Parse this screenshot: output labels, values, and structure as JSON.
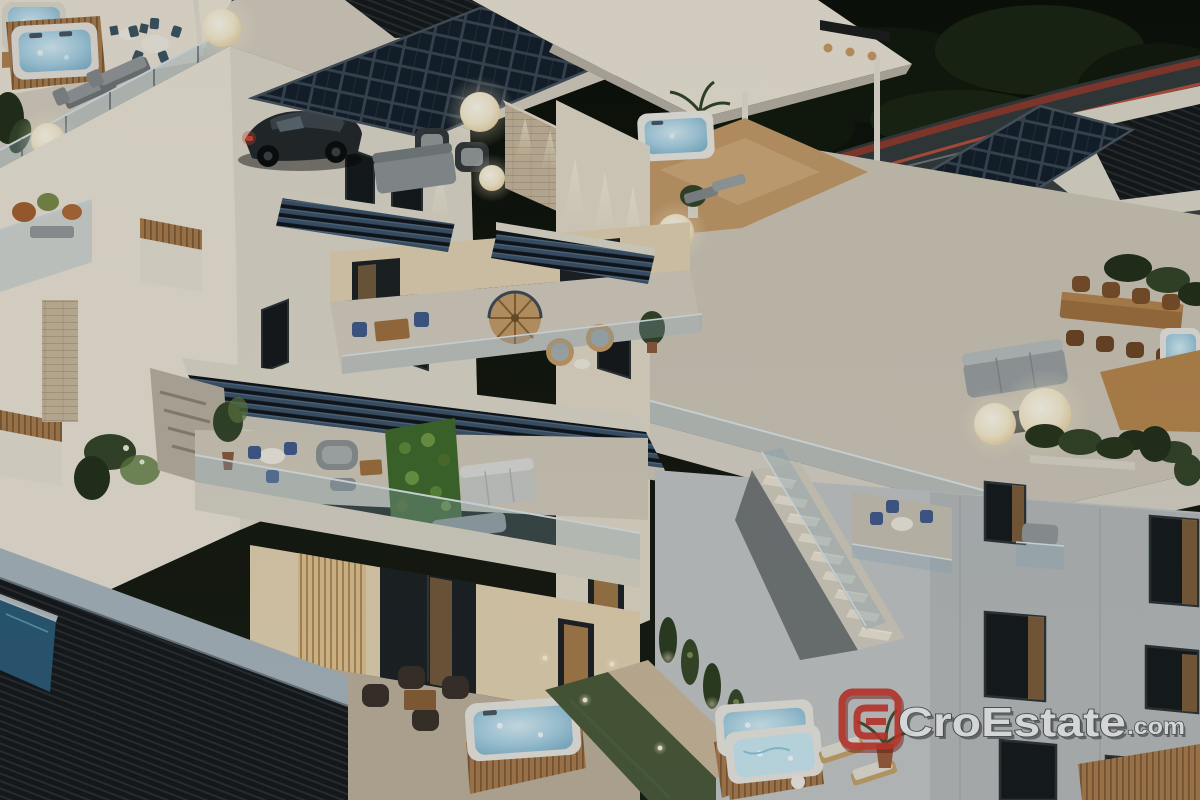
{
  "image": {
    "kind": "3d-architectural-rendering",
    "scene": "modern terraced apartment complex at dusk",
    "time_of_day": "dusk"
  },
  "watermark": {
    "brand": "CroEstate",
    "suffix": ".com",
    "emblem": "ce-monogram",
    "emblem_color": "#b23128",
    "text_fill": "#d9dbdd",
    "text_outline": "#3f4448"
  },
  "palette": {
    "c-night": "#0e120c",
    "c-veg": "#1b2615",
    "c-veg-dark": "#11190d",
    "c-road": "#333a3d",
    "c-apron": "#42484c",
    "c-trail-red": "#b23a28",
    "c-trail-red2": "#d8553c",
    "c-trail-light": "#dceef5",
    "c-pool": "#2a6484",
    "c-pool-lane": "#85c8de",
    "c-wall-lit": "#ece5d8",
    "c-wall-mid": "#d6cfc2",
    "c-wall-shade": "#b9b1a3",
    "c-wall-warm": "#e4d3b4",
    "c-brick": "#c9b89d",
    "c-brick-dark": "#a4937a",
    "c-facade-cool": "#c3c6c8",
    "c-facade-cool-dark": "#9da3a7",
    "c-window-dark": "#14191d",
    "c-frame": "#2c3338",
    "c-glass": "#8fb0c4",
    "c-slat-blue": "#3c536b",
    "c-slat-gap": "#101722",
    "c-deck-dark": "#16191c",
    "c-wood": "#b08353",
    "c-wood-dark": "#82603c",
    "c-wood-deck": "#c49a6a",
    "c-water": "#a3cfe3",
    "c-water-bright": "#c9e8f4",
    "c-lamp": "#f7ecd0",
    "c-green": "#33452a",
    "c-green-dark": "#22301b",
    "c-green-bright": "#5d7a3f",
    "c-lawn": "#49593a",
    "c-grey-sofa": "#94999c",
    "c-wicker-dark": "#38302a",
    "c-chair-blue": "#415a8e",
    "c-chair-brown": "#7c4f2c",
    "c-table-wood": "#a0713f",
    "c-car-dark": "#23282c",
    "c-car-grey": "#4e565c",
    "c-fascia-blue": "#a9b6c0"
  },
  "scene_objects": [
    "rooftop-terrace-with-jacuzzi",
    "solar-panel-carport",
    "solar-panel-array",
    "parked-car-dark",
    "parked-car-grey",
    "road-with-light-trails",
    "rooftop-pool",
    "pergola-blue-slats",
    "glass-balustrades",
    "sphere-lamps",
    "outdoor-dining-sets",
    "sun-loungers",
    "hot-tubs-wood-clad",
    "living-green-wall",
    "spiral-staircase",
    "exterior-stairs",
    "cypress-trees",
    "lawn-strip",
    "privacy-louver-screens",
    "planter-boxes"
  ]
}
